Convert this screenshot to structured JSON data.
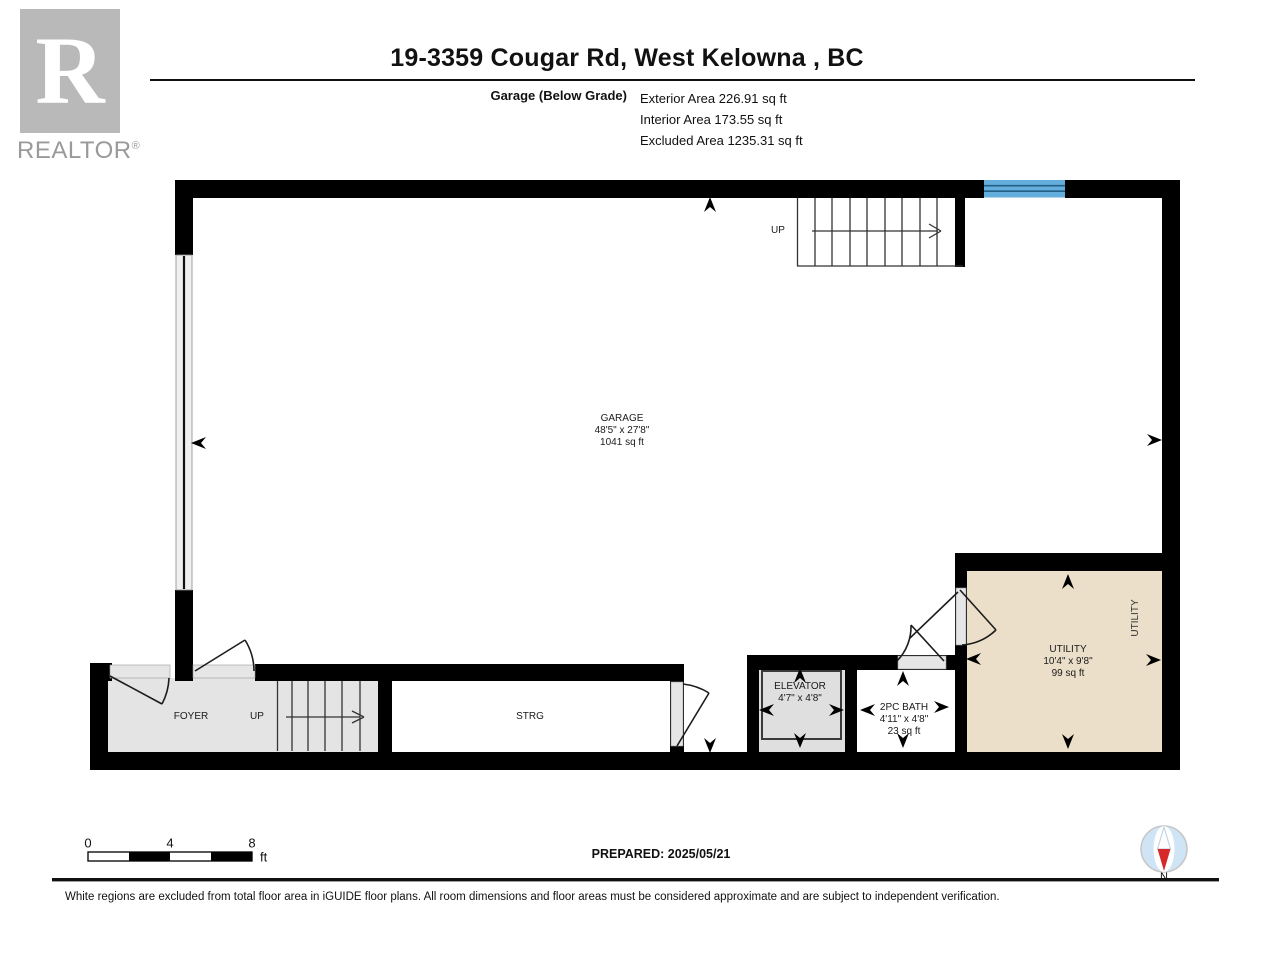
{
  "header": {
    "title": "19-3359 Cougar Rd, West Kelowna , BC",
    "floor_label": "Garage (Below Grade)",
    "stats": [
      "Exterior Area 226.91 sq ft",
      "Interior Area 173.55 sq ft",
      "Excluded Area 1235.31 sq ft"
    ]
  },
  "logo": {
    "letter": "R",
    "realtor_text": "REALTOR",
    "registered": "®"
  },
  "rooms": {
    "garage": {
      "name": "GARAGE",
      "dims": "48'5\" x 27'8\"",
      "area": "1041 sq ft"
    },
    "foyer": {
      "name": "FOYER"
    },
    "strg": {
      "name": "STRG"
    },
    "elevator": {
      "name": "ELEVATOR",
      "dims": "4'7\" x 4'8\""
    },
    "bath": {
      "name": "2PC BATH",
      "dims": "4'11\" x 4'8\"",
      "area": "23 sq ft"
    },
    "utility": {
      "name": "UTILITY",
      "dims": "10'4\" x 9'8\"",
      "area": "99 sq ft",
      "side_label": "UTILITY"
    }
  },
  "stairs": {
    "up_top": "UP",
    "up_bottom": "UP"
  },
  "scale_bar": {
    "tick0": "0",
    "tick4": "4",
    "tick8": "8",
    "unit": "ft"
  },
  "footer": {
    "prepared": "PREPARED: 2025/05/21",
    "disclaimer": "White regions are excluded from total floor area in iGUIDE floor plans. All room dimensions and floor areas must be considered approximate and are subject to independent verification.",
    "compass_n": "N"
  },
  "colors": {
    "wall": "#000000",
    "window_blue": "#64aede",
    "utility_fill": "#ebdfca",
    "gray_fill": "#e4e4e4",
    "compass_red": "#d62a2a",
    "compass_blue": "#cfe4f4"
  }
}
